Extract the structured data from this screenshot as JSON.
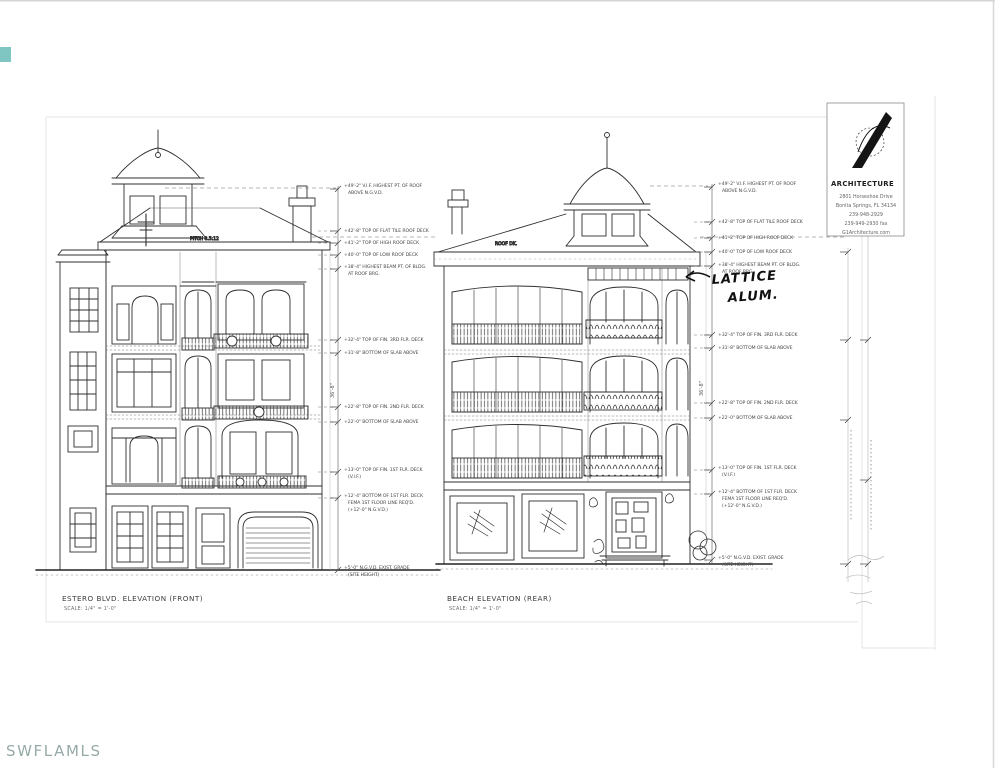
{
  "scan": {
    "watermark": "SWFLAMLS",
    "watermark_color": "#96aaa8",
    "corner_mark_color": "#5fb7b1"
  },
  "logo_block": {
    "firm": "ARCHITECTURE",
    "address": [
      "2801 Horseshoe Drive",
      "Bonita Springs, FL 34134",
      "239-948-2929",
      "239-949-2930 fax",
      "G1Architecture.com"
    ]
  },
  "titles": {
    "front": {
      "name": "ESTERO BLVD. ELEVATION (FRONT)",
      "scale": "SCALE: 1/4\" = 1'-0\""
    },
    "rear": {
      "name": "BEACH ELEVATION (REAR)",
      "scale": "SCALE: 1/4\" = 1'-0\""
    }
  },
  "roof_notes": {
    "pitch": "PITCH 8.5:12",
    "deck": "ROOF DK."
  },
  "handwriting": {
    "line1": "LATTICE",
    "line2": "ALUM."
  },
  "dimensions": {
    "left_overall": "36'-8\"",
    "right_overall": "36'-8\""
  },
  "callouts": [
    {
      "l1": "+49'-2\" V.I.F. HIGHEST PT. OF ROOF",
      "l2": "ABOVE N.G.V.D."
    },
    {
      "l1": "+42'-8\" TOP OF FLAT TILE ROOF DECK",
      "l2": ""
    },
    {
      "l1": "+41'-2\" TOP OF HIGH ROOF DECK",
      "l2": ""
    },
    {
      "l1": "+40'-0\" TOP OF LOW ROOF DECK",
      "l2": ""
    },
    {
      "l1": "+38'-4\" HIGHEST BEAM PT. OF BLDG.",
      "l2": "AT ROOF BRG."
    },
    {
      "l1": "+32'-4\" TOP OF FIN. 3RD FLR. DECK",
      "l2": ""
    },
    {
      "l1": "+31'-8\" BOTTOM OF SLAB ABOVE",
      "l2": ""
    },
    {
      "l1": "+22'-8\" TOP OF FIN. 2ND FLR. DECK",
      "l2": ""
    },
    {
      "l1": "+22'-0\" BOTTOM OF SLAB ABOVE",
      "l2": ""
    },
    {
      "l1": "+13'-0\" TOP OF FIN. 1ST FLR. DECK",
      "l2": "(V.I.F.)"
    },
    {
      "l1": "+12'-4\" BOTTOM OF 1ST FLR. DECK",
      "l2": "FEMA 1ST FLOOR LINE REQ'D.",
      "l3": "(+12'-0\" N.G.V.D.)"
    },
    {
      "l1": "+5'-0\" N.G.V.D. EXIST. GRADE",
      "l2": "(SITE HEIGHT)"
    }
  ]
}
